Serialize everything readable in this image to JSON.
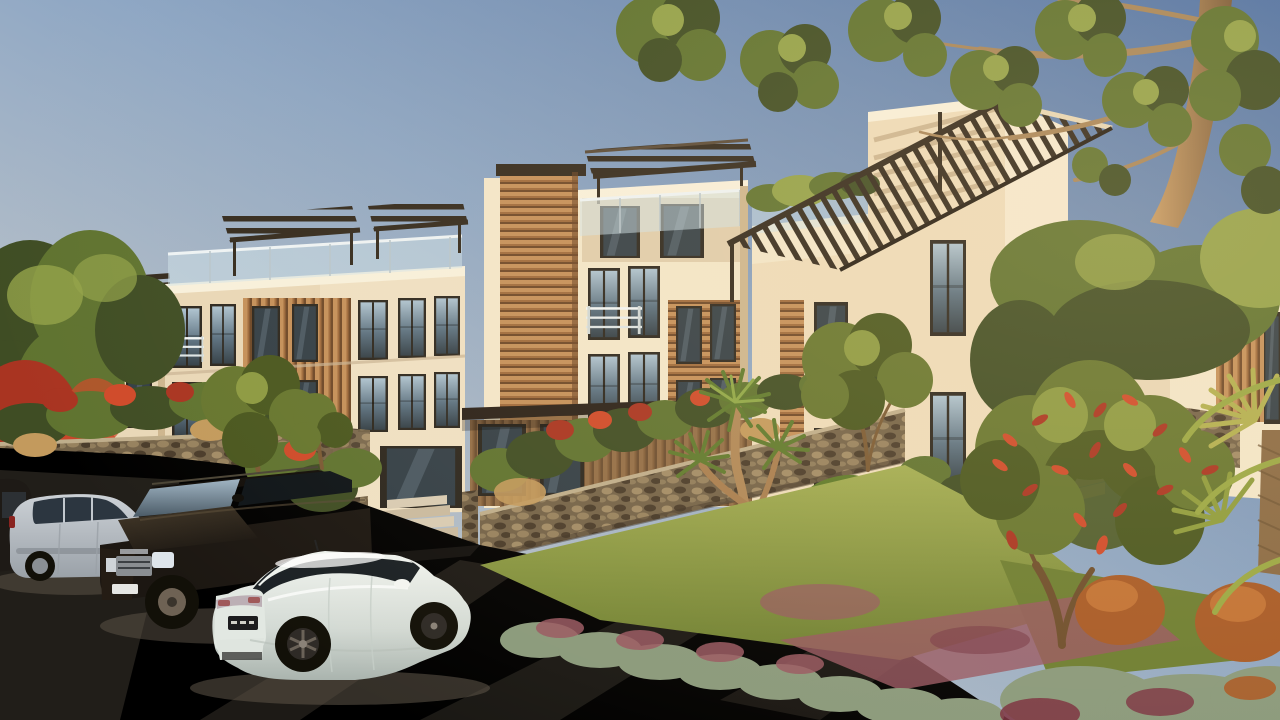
{
  "scene": {
    "type": "architectural-exterior-render",
    "time_of_day": "late-afternoon-golden-hour",
    "description": "Photorealistic rendering of a modern three-storey apartment complex with wood-slat cladding, rooftop pergolas and glass balconies, fronted by a cobbled driveway with three parked cars and lush tropical landscaping under a clear blue sky",
    "objects": {
      "building": "modern apartment complex",
      "tower": "four-storey corner tower with pergola roof",
      "pergolas": "dark timber pergola roof structures",
      "wood_panels": "warm wood slat cladding panels",
      "balustrades": "frameless glass balcony railings",
      "stone_walls": "natural stone gabion garden walls",
      "stairs": "stone entry staircases",
      "driveway": "cobblestone parking forecourt",
      "car_white_sedan": "white sedan, rear three-quarter view",
      "car_dark_suv": "dark brown luxury SUV, front three-quarter view",
      "car_silver_hatchback": "silver hatchback, side view",
      "big_tree": "large overhanging tree, top right",
      "yucca_palm": "multi-head yucca palm",
      "bottlebrush_tree": "red-flowering bottlebrush tree",
      "gardens": "mixed tropical planting with grasses and groundcover"
    }
  },
  "palette": {
    "sky_deep": "#4f72a6",
    "sky_mid": "#8da6c4",
    "sky_pale": "#ddd8cd",
    "wall_lit": "#f3e7cb",
    "wall_cream": "#e9d8b8",
    "wall_shade": "#cdb68f",
    "parapet_light": "#f8f1dd",
    "wood_light": "#c4905a",
    "wood_mid": "#9f6b3d",
    "wood_dark": "#6e4828",
    "pergola_dark": "#332a1e",
    "frame_dark": "#2c271f",
    "glass_top": "#aec4d2",
    "glass_mid": "#5c7282",
    "glass_dark": "#333f47",
    "balustrade": "#cfe4ec",
    "stone_light": "#a28c67",
    "stone_mid": "#746349",
    "stone_dark": "#4a3c2b",
    "lawn_light": "#a3ae53",
    "lawn_dark": "#6d7e31",
    "green_dark": "#3f4d24",
    "green_mid": "#5f7330",
    "green_lit": "#93a24a",
    "olive": "#66762f",
    "olive_dark": "#49571f",
    "olive_lit": "#8c9a42",
    "red_flower": "#a93421",
    "red_bright": "#cf4a2a",
    "purple_ground": "#995862",
    "rust_grass": "#a85a26",
    "tan_grass": "#c39a5d",
    "blue_grass": "#8a9a7c",
    "trunk_lit": "#c89c66",
    "trunk_dark": "#7c5c3a",
    "pave_light": "#d8cdb6",
    "pave_dark": "#8d8274",
    "shadow_col": "#5f5549",
    "car_silver": "#ccd1d6",
    "car_silver_dark": "#9aa1a8",
    "car_dark": "#1c1712",
    "car_dark_lit": "#453a2a",
    "car_white": "#f2f5f1",
    "car_white_dark": "#aab4ae",
    "tyre": "#121008",
    "alloy": "#6e6254",
    "chrome": "#c9ced2",
    "glow": "#ffd9a0"
  }
}
